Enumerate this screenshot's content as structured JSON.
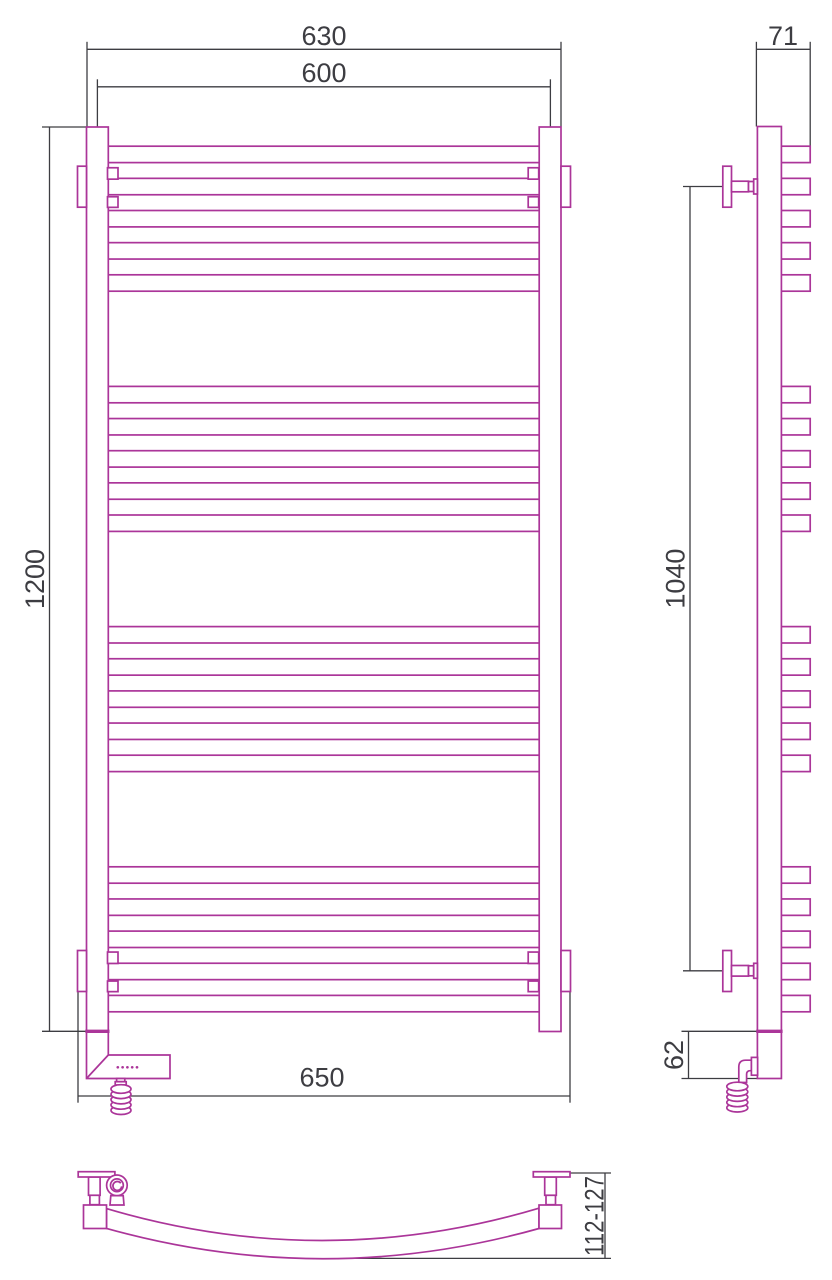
{
  "labels": {
    "top_width": "630",
    "center_width": "600",
    "height": "1200",
    "overall_width": "650",
    "depth": "71",
    "bracket_span": "1040",
    "heater_height": "62",
    "wall_clearance": "112-127"
  },
  "colors": {
    "outline": "#ab3599",
    "dimension": "#3d3d42",
    "background": "#ffffff"
  },
  "structure": {
    "bar_groups": 4,
    "bars_per_group": 5,
    "first_bar_top": 146.2,
    "group_pitch": 240.2,
    "bar_pitch": 32.15,
    "bar_height": 16.4,
    "front_bar": {
      "x": 107,
      "w": 433.8
    },
    "side_stub": {
      "x": 781,
      "w": 29.2
    }
  }
}
